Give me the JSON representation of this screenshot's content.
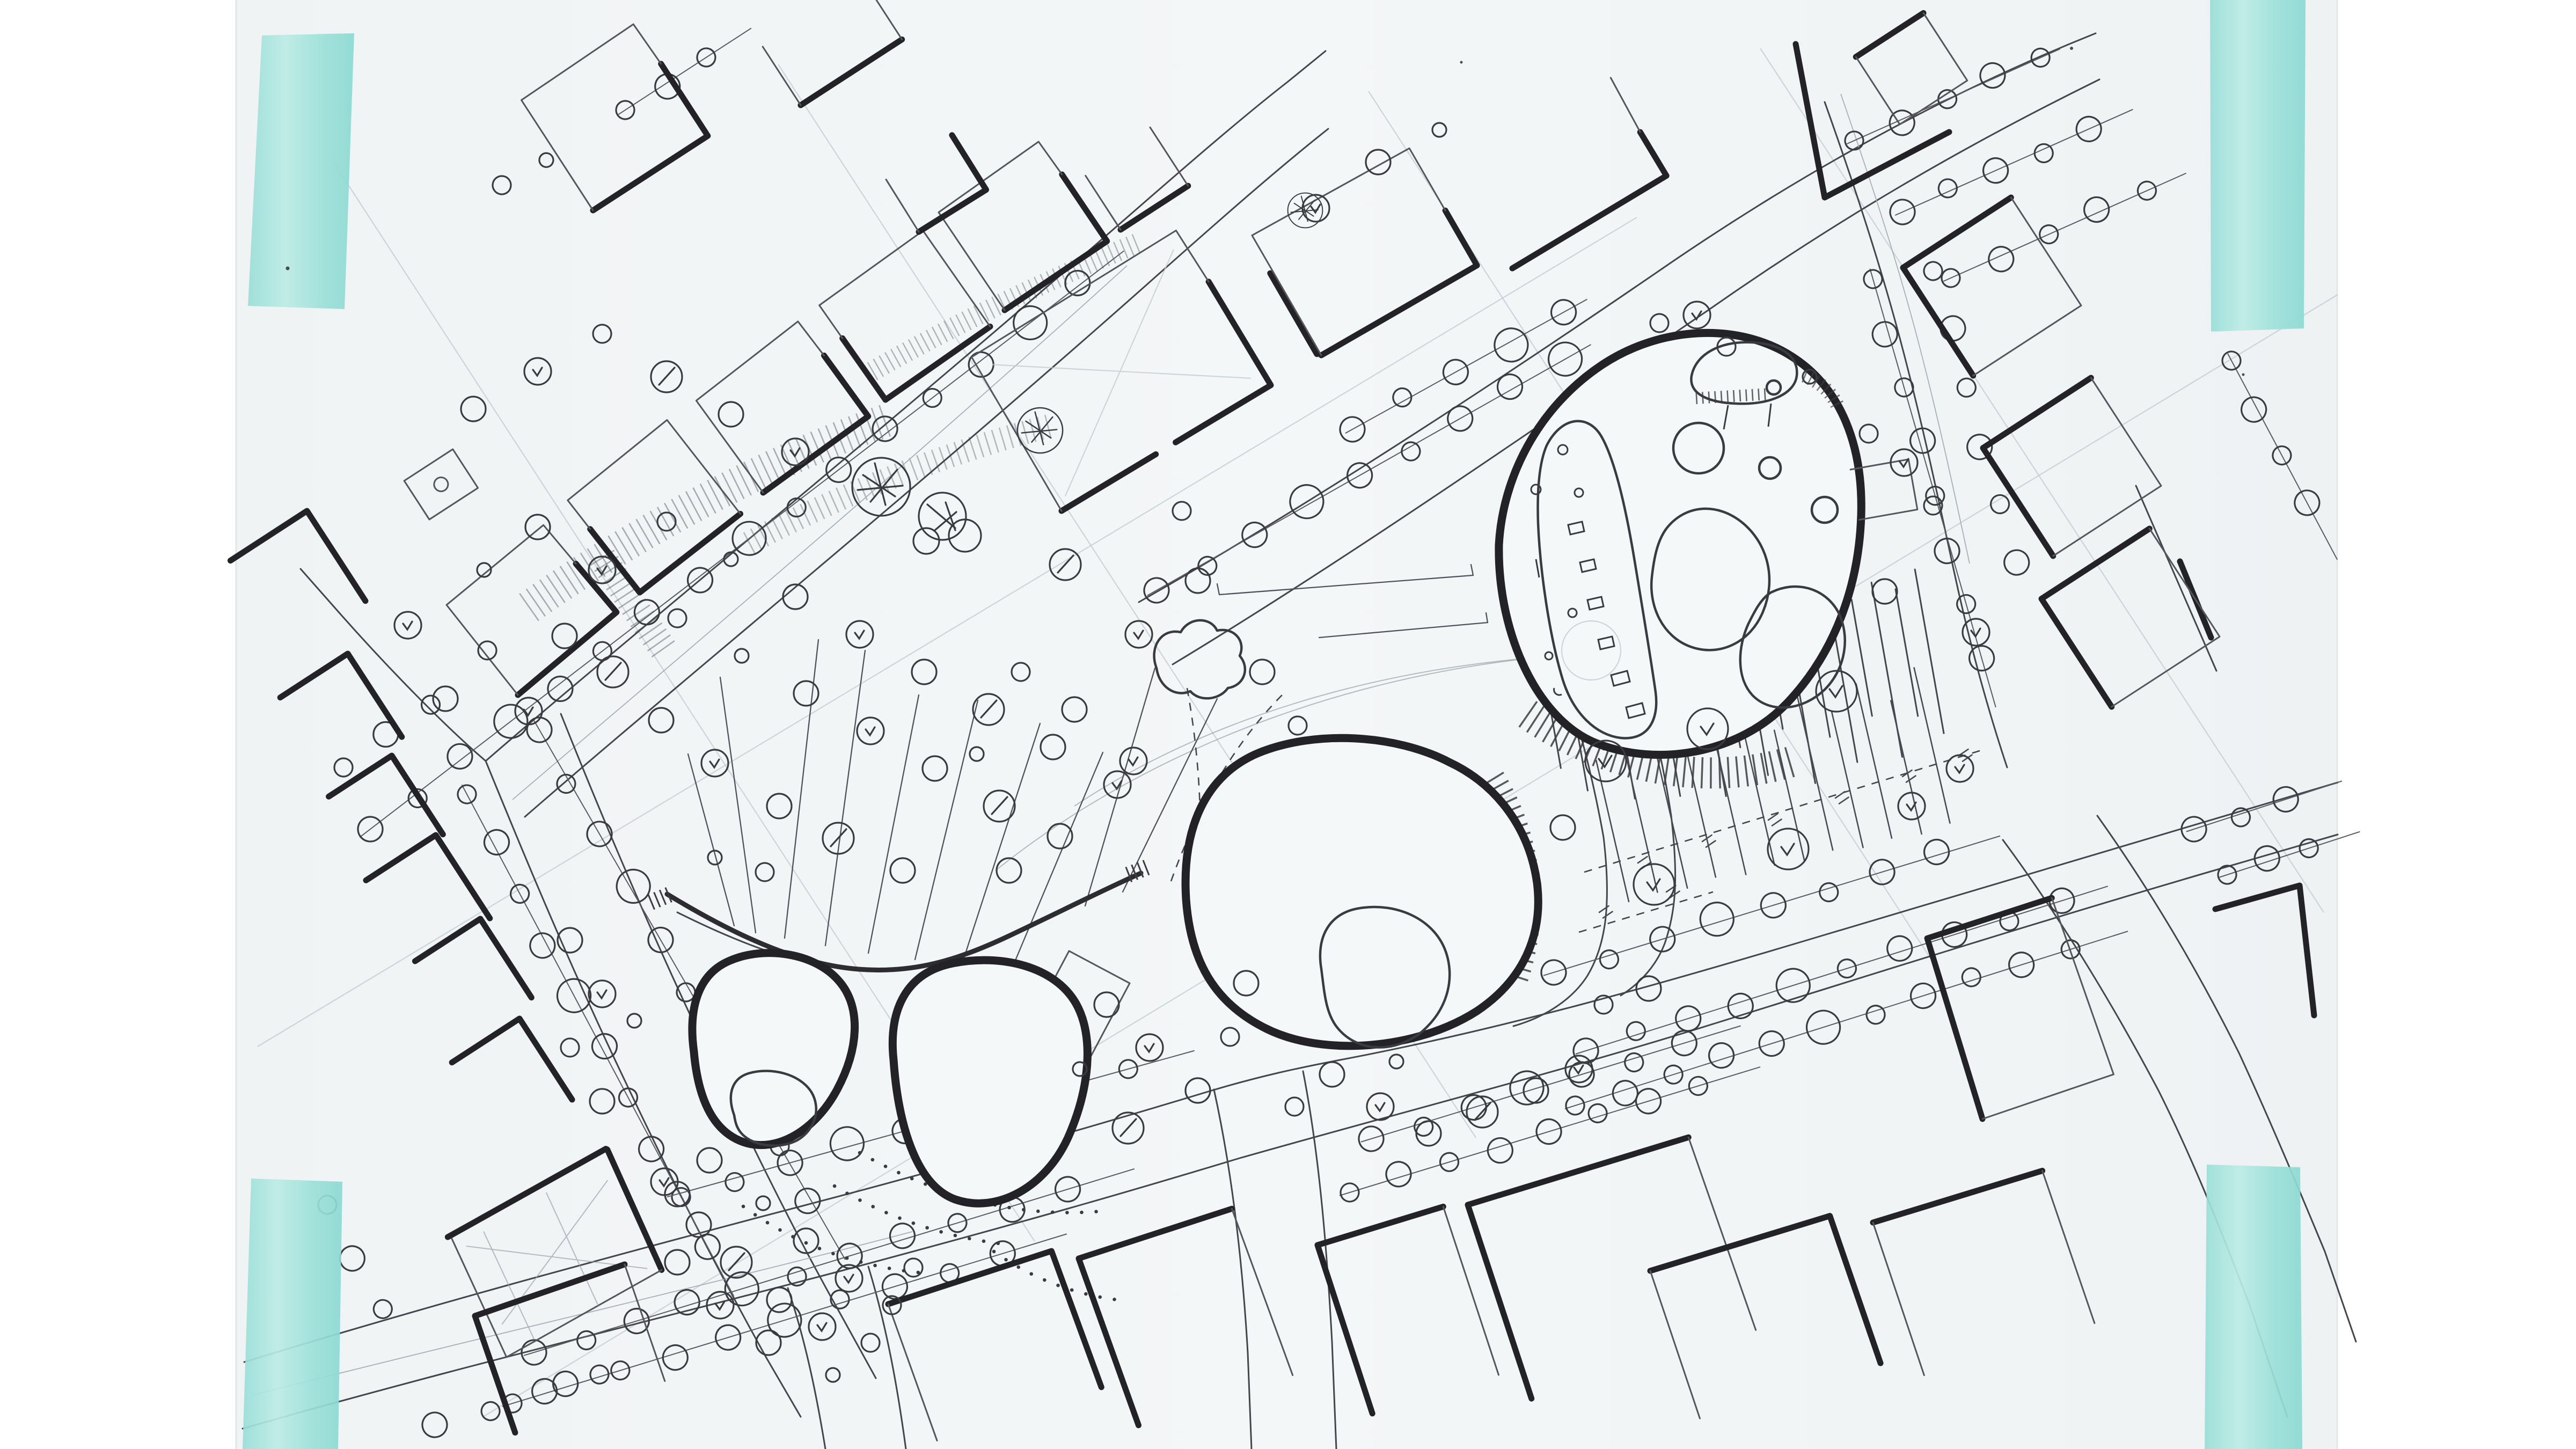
{
  "document": {
    "kind": "scanned hand-drawn architectural site plan sketch",
    "media": "ink pen and pencil on paper, fixed with teal tape at the four corners",
    "aria_label": "Hand-drawn urban design site plan sketch: three organic blob-shaped pavilions with inner courtyards set in a diagonally rotated street grid of rectangular city blocks, rows of street trees drawn as circles, a park with scattered trees and hatched slope bands, a parking court with stall lines, and teal masking tape strips at each corner of the paper",
    "visible_text": []
  },
  "palette": {
    "scan_background": "#ffffff",
    "paper": "#f2f5f6",
    "ink_heavy": "#232327",
    "ink": "#45454c",
    "ink_light": "#55555c",
    "pencil": "#c3c8cf",
    "tape_teal": "#96dcd5",
    "tape_teal_light": "#bcebe5"
  },
  "tape_marks": {
    "count": 4,
    "color": "#96dcd5",
    "positions": [
      "top-left",
      "top-right",
      "bottom-left",
      "bottom-right"
    ]
  },
  "plan_features": {
    "organic_buildings": [
      {
        "name": "west-twin-pavilions",
        "description": "two rounded pavilions joined by a long curved canopy, left pavilion with inner courtyard"
      },
      {
        "name": "central-pavilion",
        "description": "egg-shaped pavilion with small inner courtyard and hatched eastern edge"
      },
      {
        "name": "northeast-pavilion",
        "description": "large rounded pavilion with central courtyard, room band with furniture marks, upper bean-shaped annex"
      }
    ],
    "context_elements": [
      "rectangular block buildings with heavy partial outlines",
      "diagonal street grid",
      "street trees as circles threaded on lines",
      "park with scattered trees and hatched terrain bands",
      "parking court with stall lines and dashed limits",
      "dotted paving trails",
      "thin radiating guide lines across the plaza"
    ]
  }
}
